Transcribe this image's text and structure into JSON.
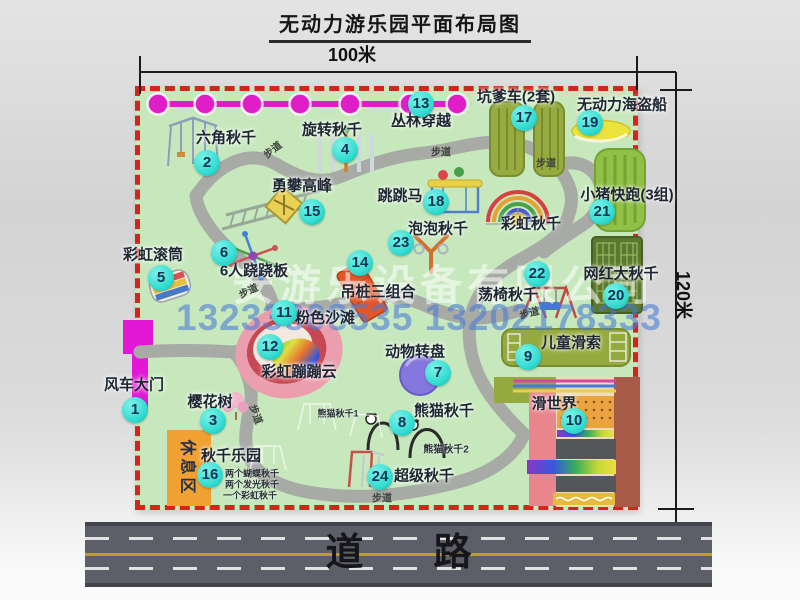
{
  "title": "无动力游乐园平面布局图",
  "dimensions": {
    "width": "100米",
    "height": "120米"
  },
  "road": {
    "label": "道路"
  },
  "watermark": {
    "company": "安游乐设备有限公司",
    "phone": "13233808535 13202178333"
  },
  "rest_area": {
    "label": "休息区"
  },
  "map": {
    "attractions": [
      {
        "num": "1",
        "name": "风车大门",
        "badge": [
          135,
          410
        ],
        "label": [
          134,
          384
        ]
      },
      {
        "num": "2",
        "name": "六角秋千",
        "badge": [
          207,
          163
        ],
        "label": [
          226,
          137
        ]
      },
      {
        "num": "3",
        "name": "樱花树",
        "badge": [
          213,
          421
        ],
        "label": [
          210,
          401
        ]
      },
      {
        "num": "4",
        "name": "旋转秋千",
        "badge": [
          345,
          150
        ],
        "label": [
          332,
          129
        ]
      },
      {
        "num": "5",
        "name": "彩虹滚筒",
        "badge": [
          161,
          278
        ],
        "label": [
          153,
          254
        ]
      },
      {
        "num": "6",
        "name": "6人跷跷板",
        "badge": [
          224,
          253
        ],
        "label": [
          254,
          270
        ]
      },
      {
        "num": "7",
        "name": "动物转盘",
        "badge": [
          438,
          373
        ],
        "label": [
          415,
          351
        ]
      },
      {
        "num": "8",
        "name": "熊猫秋千",
        "badge": [
          402,
          423
        ],
        "label": [
          444,
          410
        ]
      },
      {
        "num": "9",
        "name": "儿童滑索",
        "badge": [
          528,
          357
        ],
        "label": [
          571,
          342
        ]
      },
      {
        "num": "10",
        "name": "滑世界",
        "badge": [
          574,
          421
        ],
        "label": [
          554,
          403
        ]
      },
      {
        "num": "11",
        "name": "粉色沙滩",
        "badge": [
          284,
          313
        ],
        "label": [
          325,
          317
        ]
      },
      {
        "num": "12",
        "name": "彩虹蹦蹦云",
        "badge": [
          270,
          347
        ],
        "label": [
          299,
          371
        ]
      },
      {
        "num": "13",
        "name": "丛林穿越",
        "badge": [
          421,
          104
        ],
        "label": [
          421,
          120
        ]
      },
      {
        "num": "14",
        "name": "吊桩三组合",
        "badge": [
          360,
          263
        ],
        "label": [
          378,
          291
        ]
      },
      {
        "num": "15",
        "name": "勇攀高峰",
        "badge": [
          312,
          212
        ],
        "label": [
          302,
          185
        ]
      },
      {
        "num": "16",
        "name": "秋千乐园",
        "badge": [
          210,
          475
        ],
        "label": [
          231,
          455
        ]
      },
      {
        "num": "17",
        "name": "坑爹车(2套)",
        "badge": [
          524,
          118
        ],
        "label": [
          516,
          96
        ]
      },
      {
        "num": "18",
        "name": "跳跳马",
        "badge": [
          436,
          202
        ],
        "label": [
          400,
          195
        ]
      },
      {
        "num": "19",
        "name": "无动力海盗船",
        "badge": [
          590,
          123
        ],
        "label": [
          622,
          104
        ]
      },
      {
        "num": "20",
        "name": "网红大秋千",
        "badge": [
          616,
          296
        ],
        "label": [
          621,
          273
        ]
      },
      {
        "num": "21",
        "name": "小猪快跑(3组)",
        "badge": [
          602,
          212
        ],
        "label": [
          627,
          194
        ]
      },
      {
        "num": "22",
        "name": "荡椅秋千",
        "badge": [
          537,
          274
        ],
        "label": [
          508,
          294
        ]
      },
      {
        "num": "23",
        "name": "泡泡秋千",
        "badge": [
          401,
          243
        ],
        "label": [
          438,
          228
        ]
      },
      {
        "num": "24",
        "name": "超级秋千",
        "badge": [
          380,
          477
        ],
        "label": [
          424,
          475
        ]
      },
      {
        "num": "",
        "name": "彩虹秋千",
        "badge": null,
        "label": [
          531,
          223
        ]
      }
    ],
    "trail_labels": [
      {
        "t": "步道",
        "x": 272,
        "y": 149,
        "rot": -38
      },
      {
        "t": "步道",
        "x": 441,
        "y": 151,
        "rot": 0
      },
      {
        "t": "步道",
        "x": 546,
        "y": 162,
        "rot": 0
      },
      {
        "t": "步道",
        "x": 248,
        "y": 290,
        "rot": -25
      },
      {
        "t": "步道",
        "x": 529,
        "y": 312,
        "rot": -15
      },
      {
        "t": "步道",
        "x": 257,
        "y": 414,
        "rot": 70
      },
      {
        "t": "步道",
        "x": 382,
        "y": 497,
        "rot": 0
      }
    ],
    "notes": [
      {
        "t": "熊猫秋千1",
        "x": 338,
        "y": 413,
        "s": 9
      },
      {
        "t": "熊猫秋千2",
        "x": 446,
        "y": 448,
        "s": 10
      },
      {
        "t": "两个蝴蝶秋千",
        "x": 252,
        "y": 473,
        "s": 9
      },
      {
        "t": "两个发光秋千",
        "x": 252,
        "y": 484,
        "s": 9
      },
      {
        "t": "一个彩虹秋千",
        "x": 250,
        "y": 495,
        "s": 9
      }
    ],
    "icons": [
      "jungle-crossing-line",
      "hexagon-swing-icon",
      "rotating-swing-icon",
      "climbing-frame-icon",
      "rainbow-roller-icon",
      "seesaw-icon",
      "jumping-horse-icon",
      "rainbow-swing-arcs-icon",
      "bubble-swing-icon",
      "hanging-piles-icon",
      "pink-beach-icon",
      "rainbow-cloud-icon",
      "animal-turntable-icon",
      "panda-swing-icon",
      "chair-swing-icon",
      "pit-car-track-icon",
      "pirate-ship-icon",
      "piggy-run-icon",
      "big-swing-net-icon",
      "zipline-icon",
      "slide-world-icon",
      "super-swing-icon",
      "cherry-tree-icon",
      "windmill-gate-icon"
    ]
  },
  "colors": {
    "park_green": "#c7e8bd",
    "border_red": "#d3261a",
    "badge_teal": "#35ddd2",
    "gate_magenta": "#e318d6",
    "rest_orange": "#f0a132",
    "road_gray": "#5d5f68",
    "jungle_magenta": "#e01ec8"
  }
}
